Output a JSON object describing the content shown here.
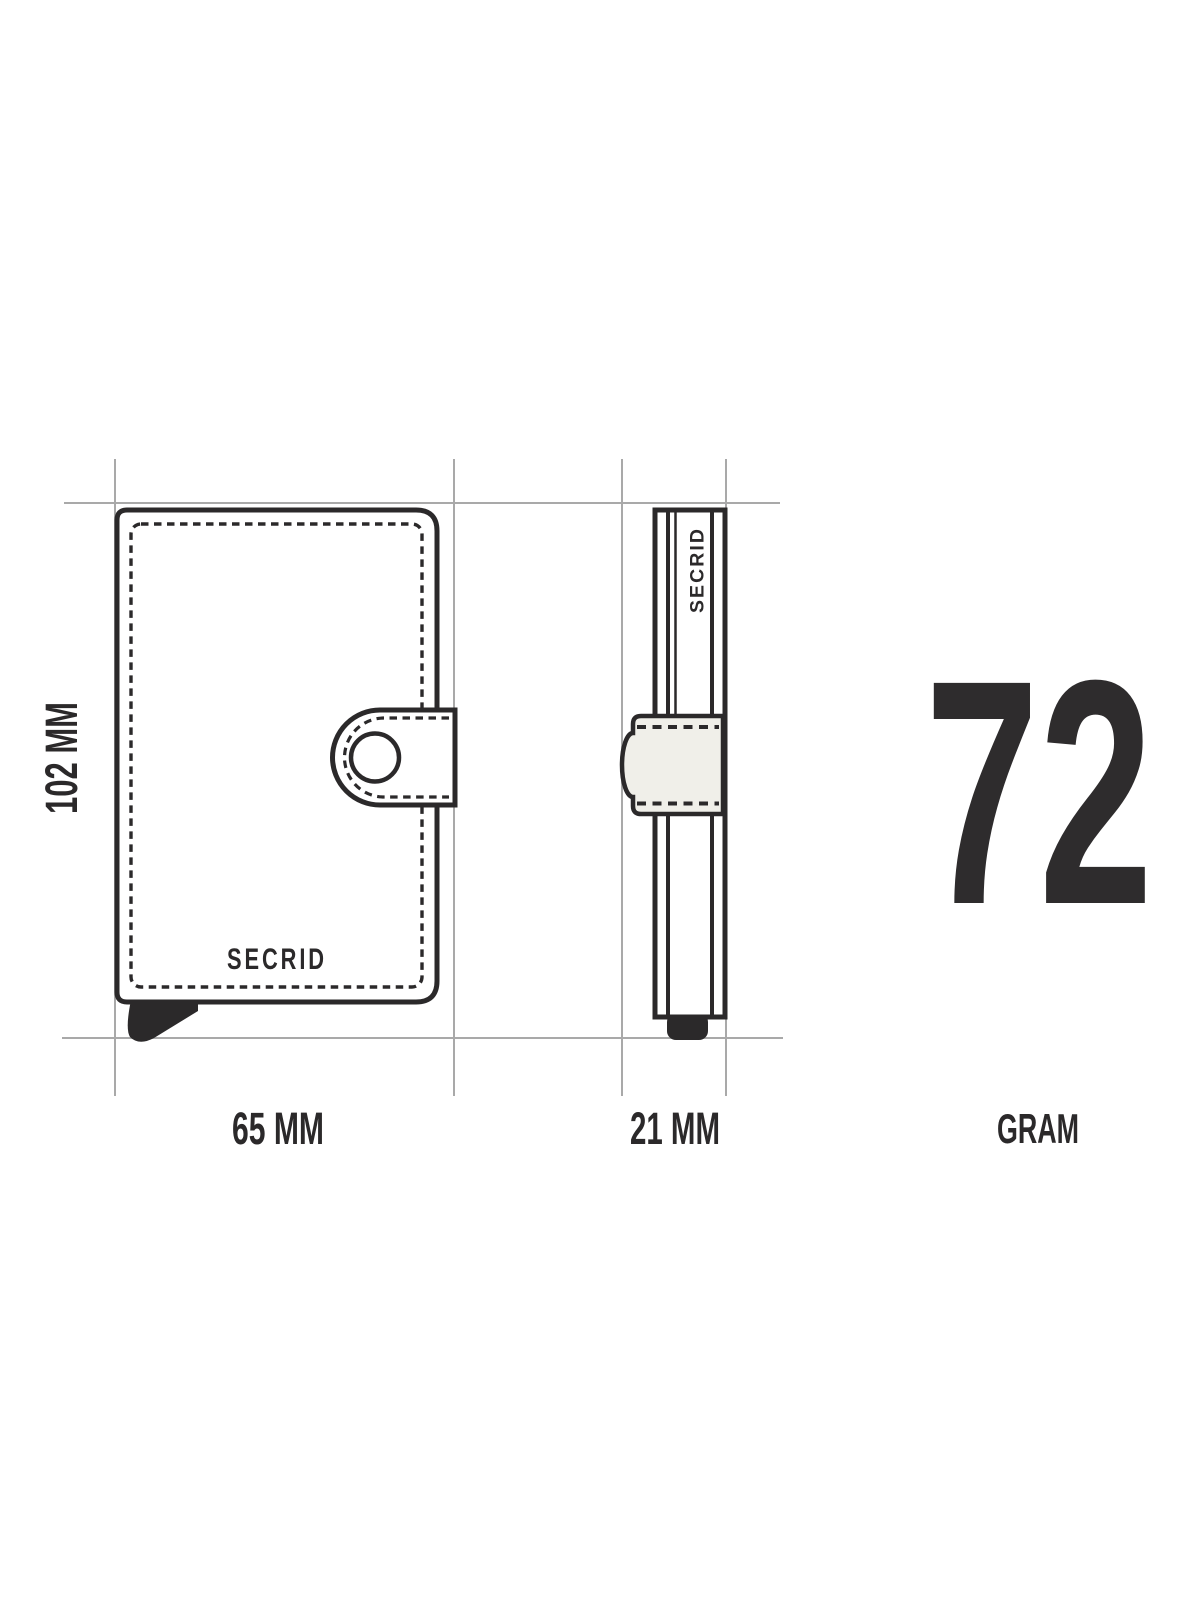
{
  "colors": {
    "bg": "#ffffff",
    "ink": "#2b292a",
    "guide": "#a9a9a9",
    "strap": "#f0efe9",
    "num": "#2e2c2d"
  },
  "diagram": {
    "front_view": {
      "brand": "SECRID",
      "height_label": "102 MM",
      "width_label": "65 MM"
    },
    "side_view": {
      "brand": "SECRID",
      "depth_label": "21 MM"
    },
    "weight": {
      "value": "72",
      "unit_label": "GRAM"
    }
  }
}
